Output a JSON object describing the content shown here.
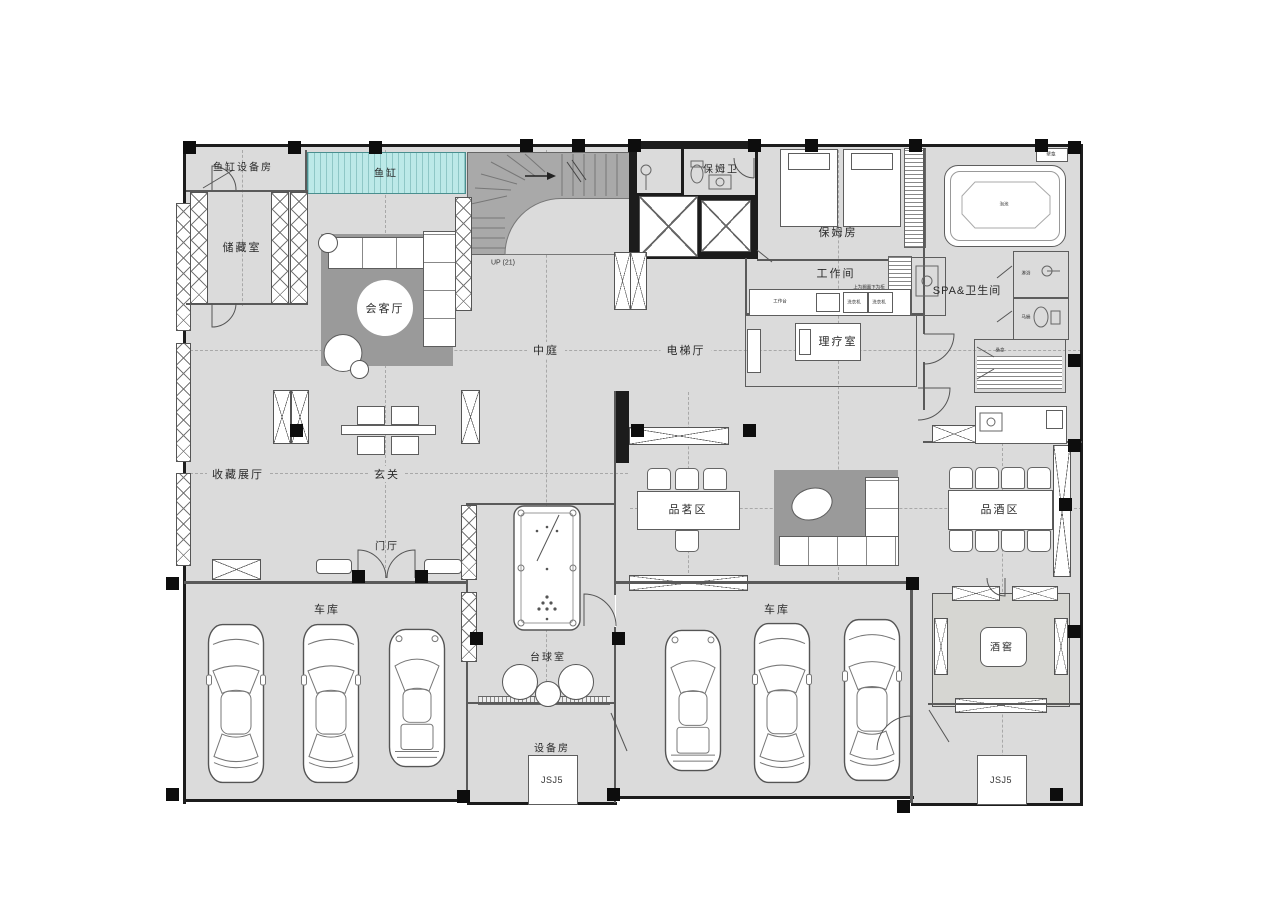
{
  "title": "别墅一层平面布置图",
  "colors": {
    "floor": "#dbdbdb",
    "carpet": "#9a9a9a",
    "stair": "#a9a9a9",
    "fish_tank": "#bce9e8",
    "wall": "#111111",
    "line": "#555555"
  },
  "rooms": {
    "fish_equipment": {
      "label": "鱼缸设备房"
    },
    "fish_tank": {
      "label": "鱼缸"
    },
    "storage": {
      "label": "储藏室"
    },
    "reception": {
      "label": "会客厅"
    },
    "stair_note": {
      "label": "UP (21)"
    },
    "atrium": {
      "label": "中庭"
    },
    "elevator_hall": {
      "label": "电梯厅"
    },
    "nanny_bath": {
      "label": "保姆卫"
    },
    "nanny_room": {
      "label": "保姆房"
    },
    "workroom": {
      "label": "工作间"
    },
    "spa": {
      "label": "SPA&卫生间"
    },
    "therapy": {
      "label": "理疗室"
    },
    "collection": {
      "label": "收藏展厅"
    },
    "entry": {
      "label": "玄关"
    },
    "foyer": {
      "label": "门厅"
    },
    "billiards": {
      "label": "台球室"
    },
    "tea": {
      "label": "品茗区"
    },
    "wine_tasting": {
      "label": "品酒区"
    },
    "garage_left": {
      "label": "车库"
    },
    "garage_right": {
      "label": "车库"
    },
    "equipment": {
      "label": "设备房"
    },
    "cellar": {
      "label": "酒窖"
    },
    "jsj5_left": {
      "label": "JSJ5"
    },
    "jsj5_right": {
      "label": "JSJ5"
    }
  },
  "small": {
    "worktable": "工作台",
    "washer_a": "洗衣机",
    "washer_b": "洗衣机",
    "cabinet_note": "上为搁置下为柜",
    "niche": "壁龛",
    "spa_tub": "泡池",
    "shower": "淋浴",
    "toilet": "马桶",
    "sauna": "桑拿"
  }
}
